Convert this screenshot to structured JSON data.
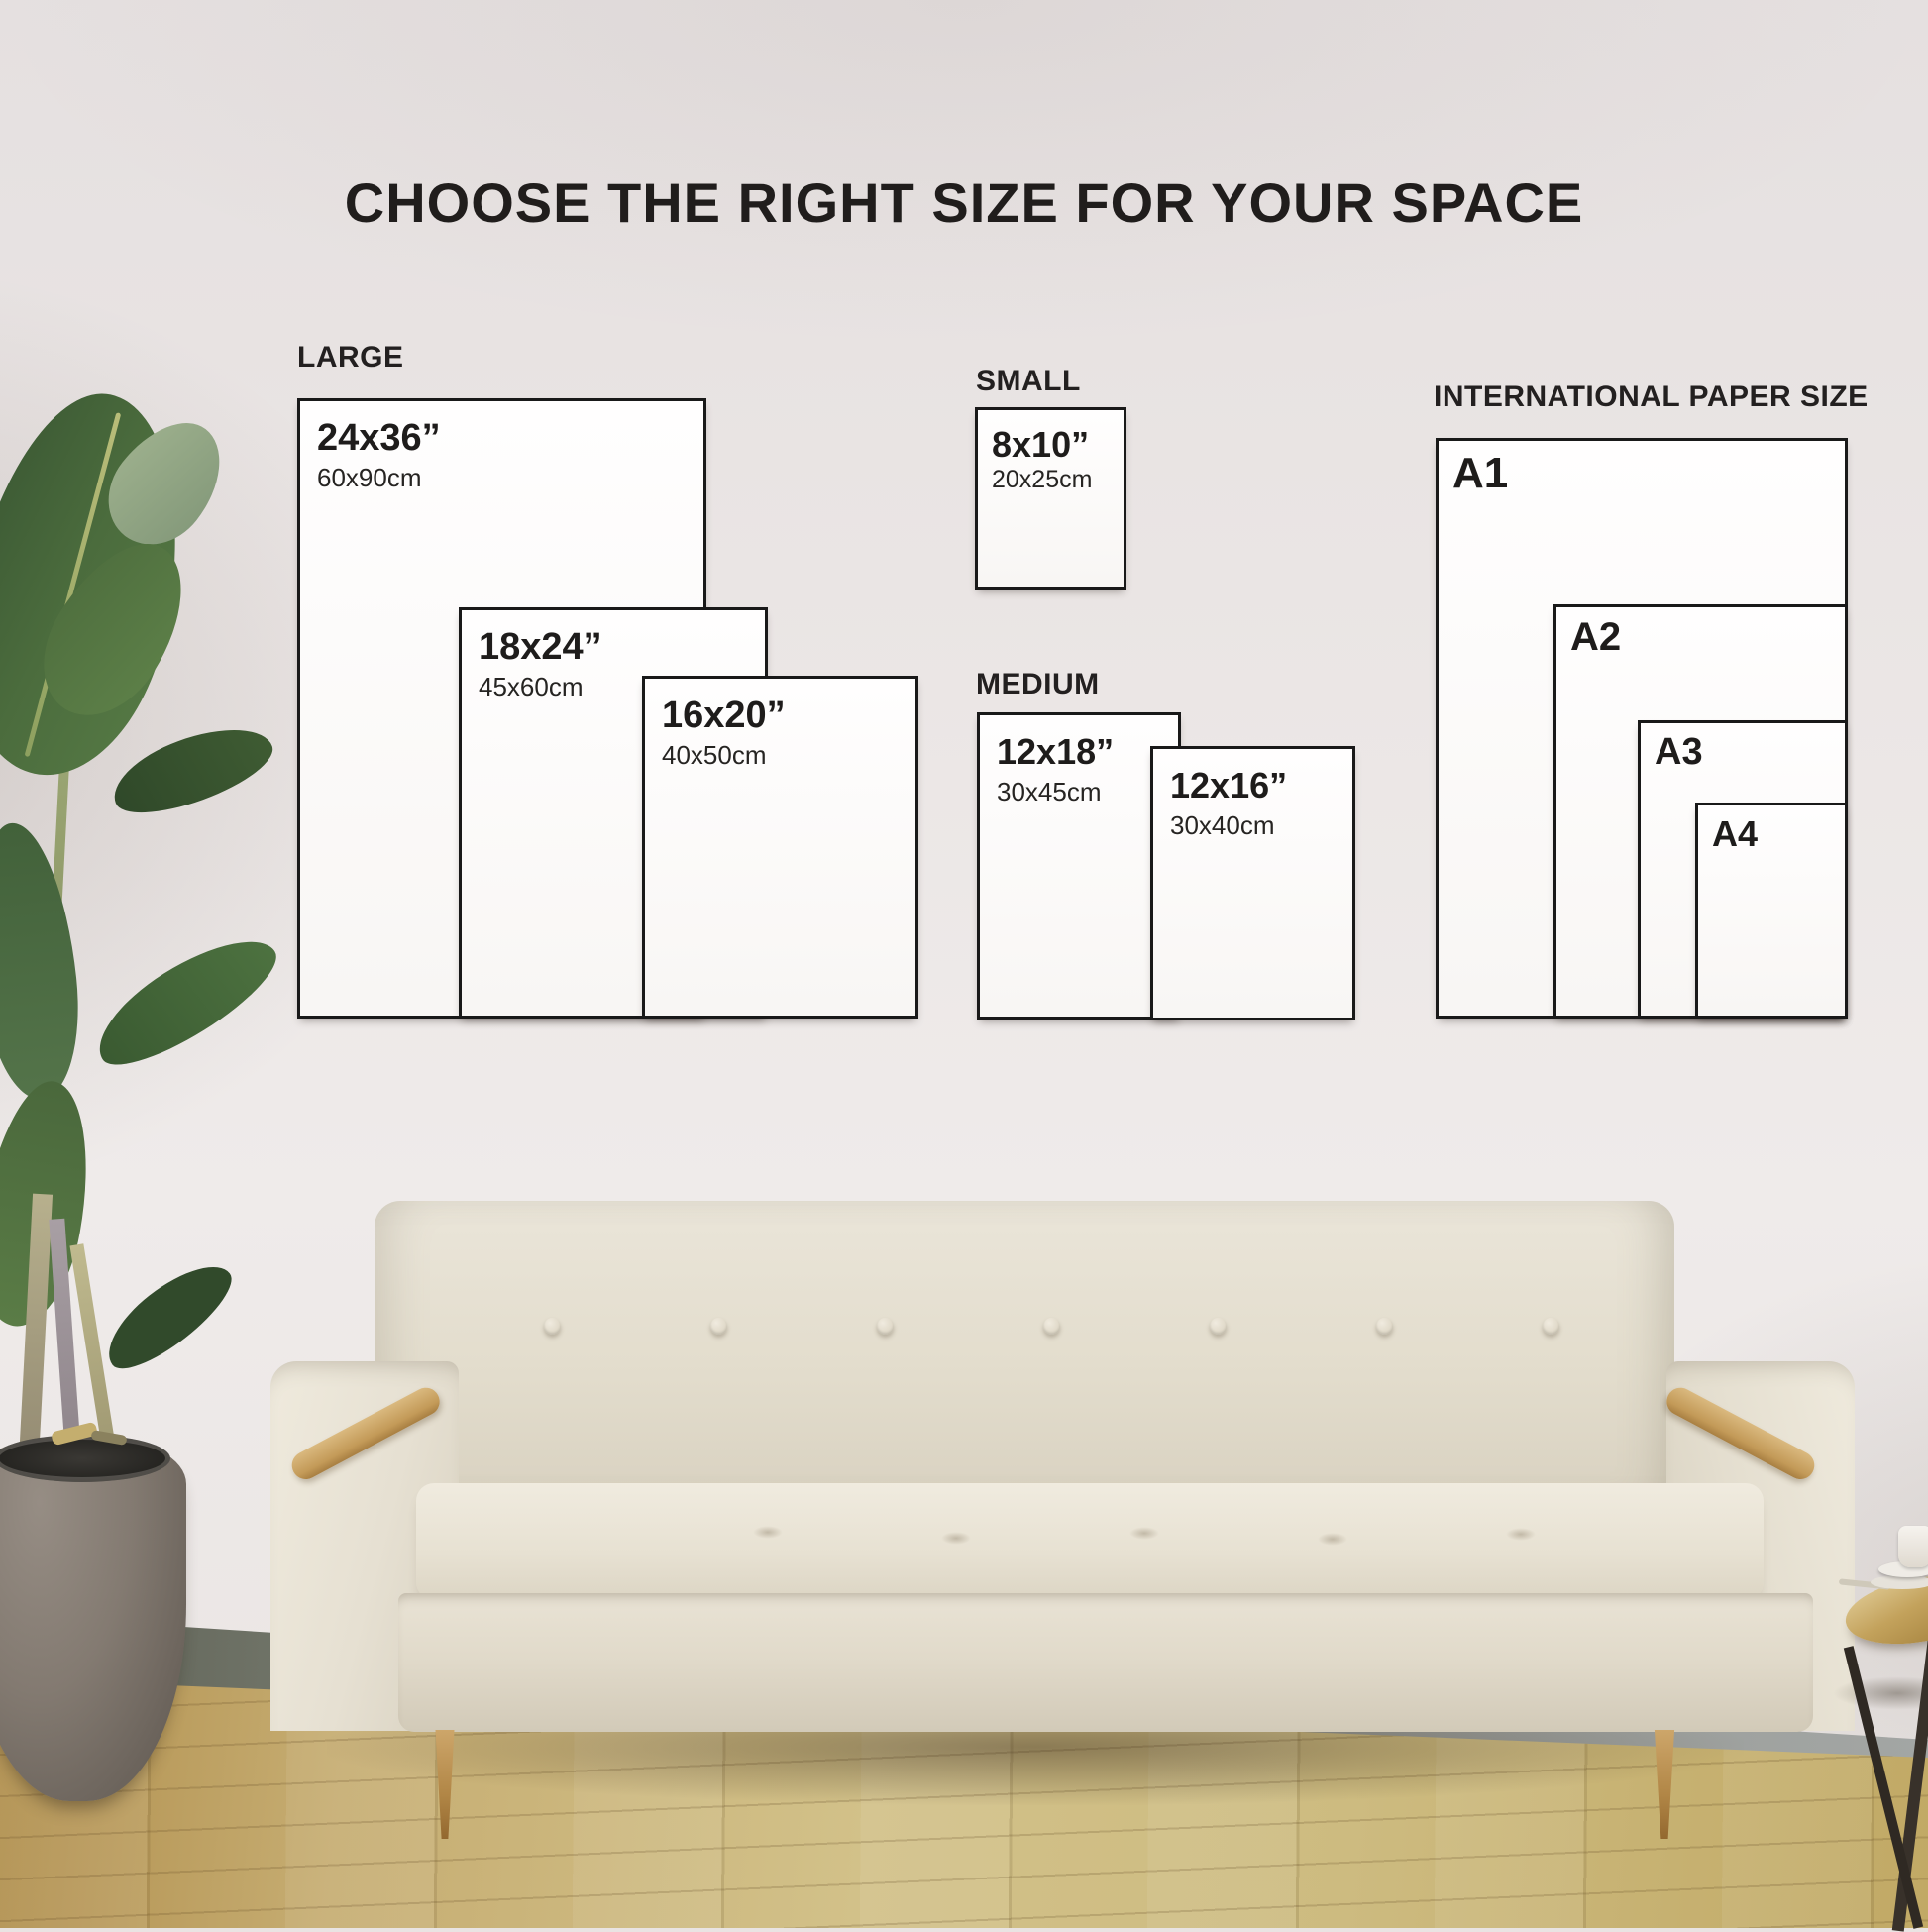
{
  "title": "CHOOSE THE RIGHT SIZE FOR YOUR SPACE",
  "sections": {
    "large": {
      "label": "LARGE",
      "boxes": [
        {
          "inches": "24x36”",
          "cm": "60x90cm"
        },
        {
          "inches": "18x24”",
          "cm": "45x60cm"
        },
        {
          "inches": "16x20”",
          "cm": "40x50cm"
        }
      ]
    },
    "small": {
      "label": "SMALL",
      "boxes": [
        {
          "inches": "8x10”",
          "cm": "20x25cm"
        }
      ]
    },
    "medium": {
      "label": "MEDIUM",
      "boxes": [
        {
          "inches": "12x18”",
          "cm": "30x45cm"
        },
        {
          "inches": "12x16”",
          "cm": "30x40cm"
        }
      ]
    },
    "international": {
      "label": "INTERNATIONAL PAPER SIZE",
      "boxes": [
        {
          "name": "A1"
        },
        {
          "name": "A2"
        },
        {
          "name": "A3"
        },
        {
          "name": "A4"
        }
      ]
    }
  },
  "scene": {
    "wall_color": "#eae5e4",
    "floor_color": "#cdbb85",
    "sofa_color": "#e5dfd1",
    "wood_accent_color": "#c39a58",
    "text_color": "#1e1c1b",
    "box_border_color": "#191919"
  }
}
